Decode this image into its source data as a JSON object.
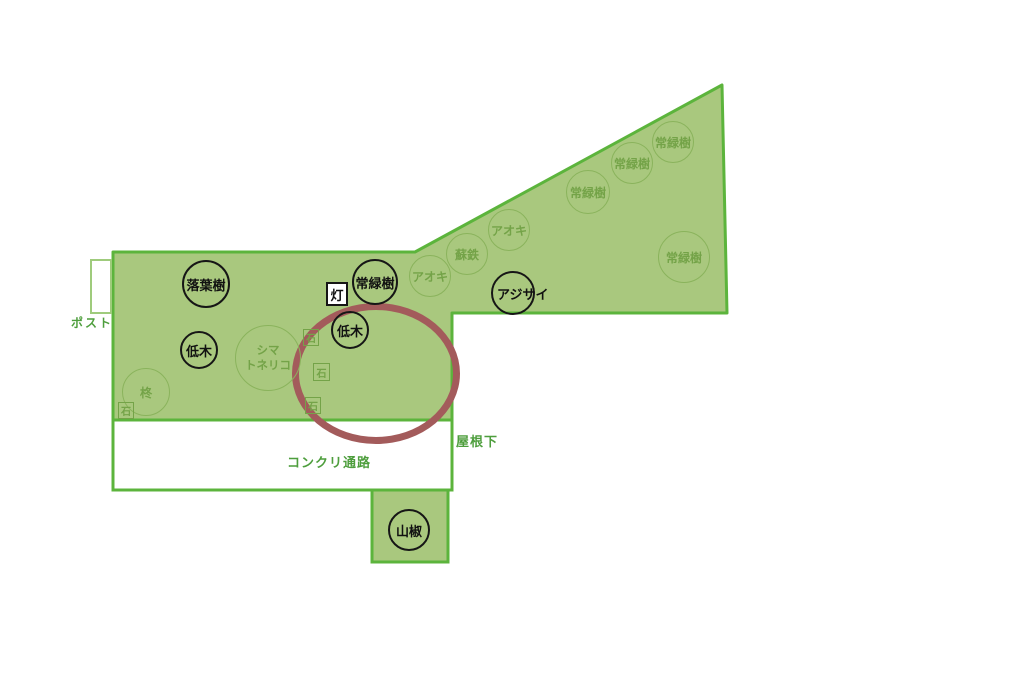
{
  "map": {
    "colors": {
      "garden_fill": "#a9c87e",
      "garden_border": "#5cb43c",
      "label_green": "#4e9e3d",
      "plant_green": "#74a348",
      "annotation_red": "#a35b5b"
    },
    "areas": {
      "post_label": "ポスト",
      "concrete_path_label": "コンクリ通路",
      "under_roof_label": "屋根下"
    },
    "plants_black": [
      {
        "id": "rakuyouju",
        "label": "落葉樹"
      },
      {
        "id": "jouryokuju-center",
        "label": "常緑樹"
      },
      {
        "id": "teiboku-left",
        "label": "低木"
      },
      {
        "id": "teiboku-center",
        "label": "低木"
      },
      {
        "id": "ajisai",
        "label": "アジサイ"
      },
      {
        "id": "sanshou",
        "label": "山椒"
      }
    ],
    "plants_green": [
      {
        "id": "jouryokuju-top-1",
        "label": "常緑樹"
      },
      {
        "id": "jouryokuju-top-2",
        "label": "常緑樹"
      },
      {
        "id": "jouryokuju-top-3",
        "label": "常緑樹"
      },
      {
        "id": "aoki-upper",
        "label": "アオキ"
      },
      {
        "id": "sotetsu",
        "label": "蘇鉄"
      },
      {
        "id": "aoki-lower",
        "label": "アオキ"
      },
      {
        "id": "jouryokuju-right",
        "label": "常緑樹"
      },
      {
        "id": "shimatoneriko",
        "label": "シマ\nトネリコ"
      },
      {
        "id": "hiiragi",
        "label": "柊"
      }
    ],
    "features": {
      "lantern_label": "灯",
      "stone_label": "石"
    }
  }
}
